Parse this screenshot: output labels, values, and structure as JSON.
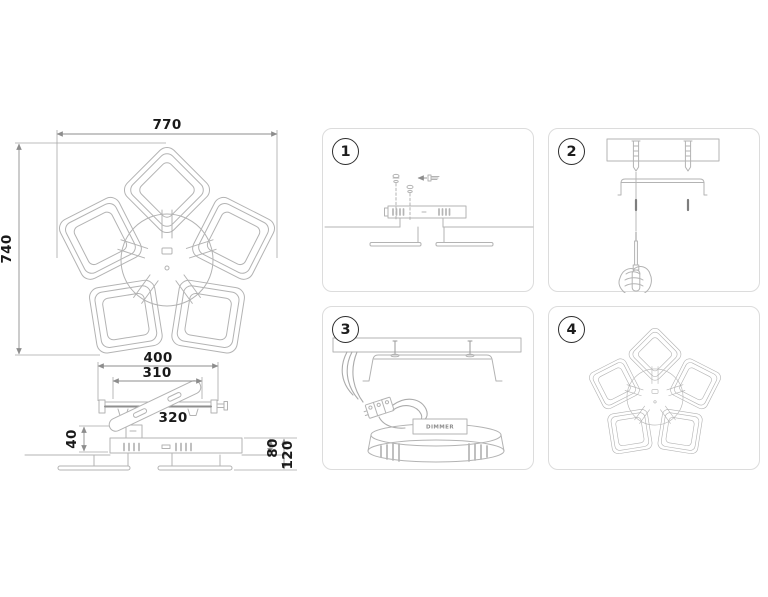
{
  "dimensions": {
    "top_view": {
      "width": "770",
      "height": "740"
    },
    "side_view": {
      "canopy_width": "400",
      "bracket_holes_span": "310",
      "bracket_length": "320",
      "bracket_height": "40",
      "body_height": "80",
      "total_height": "120"
    }
  },
  "steps": [
    {
      "number": "1"
    },
    {
      "number": "2"
    },
    {
      "number": "3"
    },
    {
      "number": "4"
    }
  ],
  "labels": {
    "driver": "DIMMER"
  },
  "colors": {
    "artwork_line": "#b3b3b3",
    "dimension_line": "#8d8d8d",
    "dimension_text": "#191919",
    "panel_border": "#dcdcdc",
    "badge_border": "#2e2e2e",
    "background": "#ffffff"
  }
}
